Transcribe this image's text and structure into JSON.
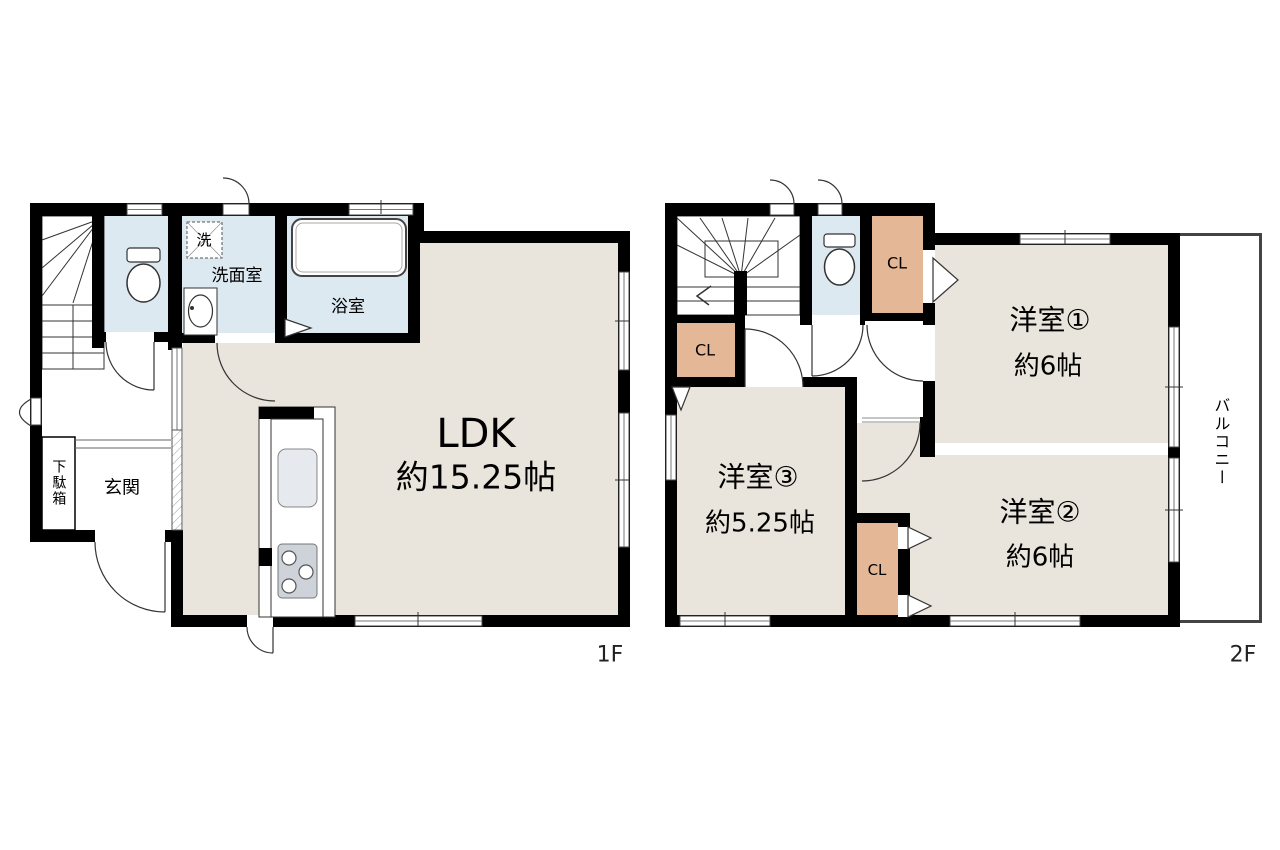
{
  "floor1": {
    "label": "1F",
    "ldk": {
      "name": "LDK",
      "area": "約15.25帖"
    },
    "washroom": "洗面室",
    "bathroom": "浴室",
    "washer": "洗",
    "entrance": "玄関",
    "shoe_cabinet": "下駄箱"
  },
  "floor2": {
    "label": "2F",
    "room1": {
      "name": "洋室①",
      "area": "約6帖"
    },
    "room2": {
      "name": "洋室②",
      "area": "約6帖"
    },
    "room3": {
      "name": "洋室③",
      "area": "約5.25帖"
    },
    "closet_label": "CL",
    "balcony": "バルコニー"
  },
  "colors": {
    "wall": "#000000",
    "room_beige": "#eae5dc",
    "wet_blue": "#dce9f1",
    "closet_tan": "#e4b897",
    "fixture_gray": "#ced3d9"
  }
}
